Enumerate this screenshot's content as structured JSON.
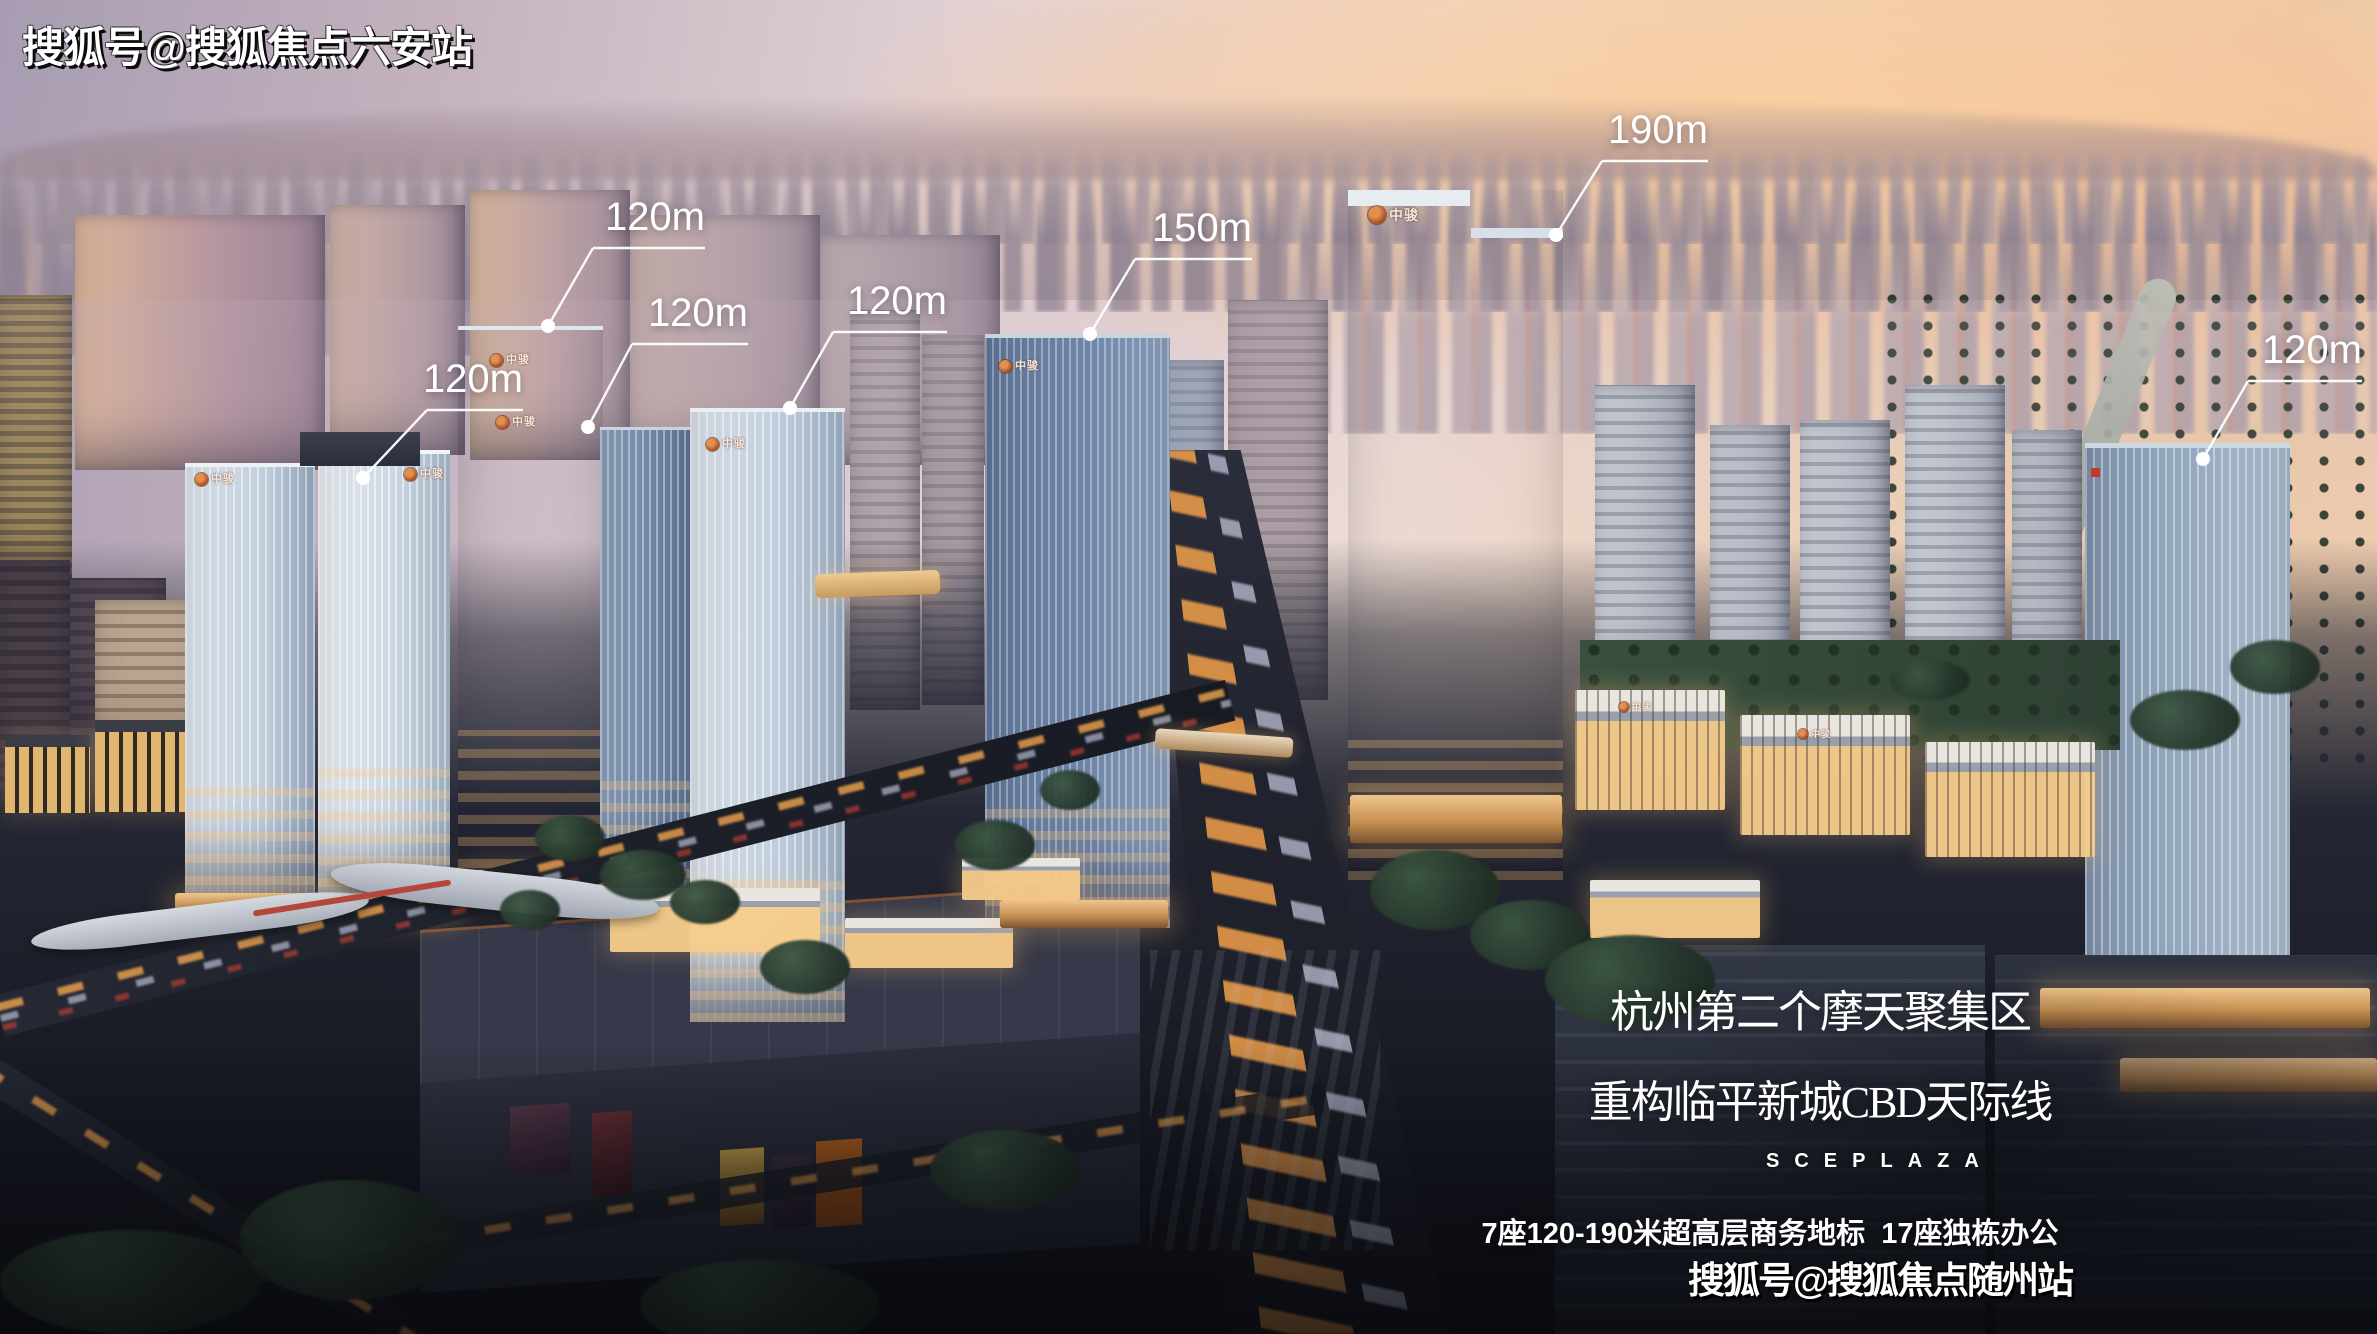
{
  "watermarks": {
    "top_left": "搜狐号@搜狐焦点六安站",
    "bottom_right": "搜狐号@搜狐焦点随州站"
  },
  "callouts": [
    {
      "text": "120m"
    },
    {
      "text": "120m"
    },
    {
      "text": "120m"
    },
    {
      "text": "120m"
    },
    {
      "text": "150m"
    },
    {
      "text": "190m"
    },
    {
      "text": "120m"
    }
  ],
  "headline": {
    "line1": "杭州第二个摩天聚集区",
    "line2": "重构临平新城CBD天际线",
    "subtitle": "SCEPLAZA",
    "stats": "7座120-190米超高层商务地标  17座独栋办公"
  },
  "brand": {
    "name": "中骏",
    "accent": "#c4602f"
  }
}
